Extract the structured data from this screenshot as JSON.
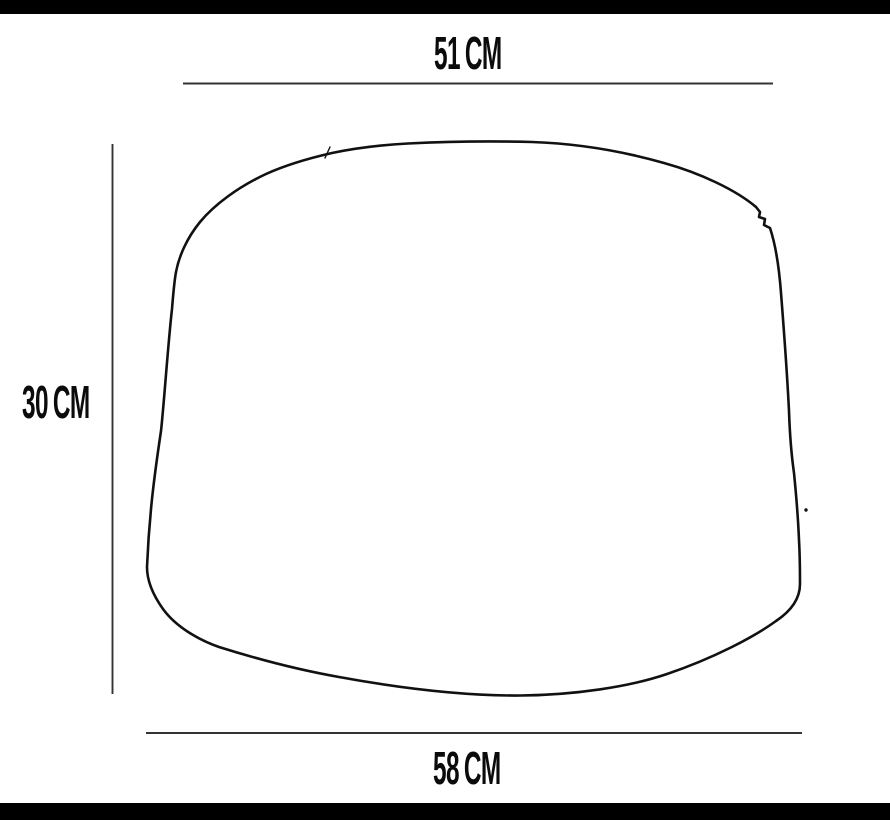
{
  "diagram": {
    "kind": "product-dimension-diagram",
    "outline_shape": "tapered-drum-pouf-outline",
    "colors": {
      "background": "#ffffff",
      "outline": "#111111",
      "dimension_line": "#333333",
      "label_text": "#0b0b0b",
      "letterbox": "#000000"
    },
    "dimensions": {
      "top_width": {
        "value": "51",
        "unit": "CM"
      },
      "height": {
        "value": "30",
        "unit": "CM"
      },
      "bottom_width": {
        "value": "58",
        "unit": "CM"
      }
    }
  }
}
